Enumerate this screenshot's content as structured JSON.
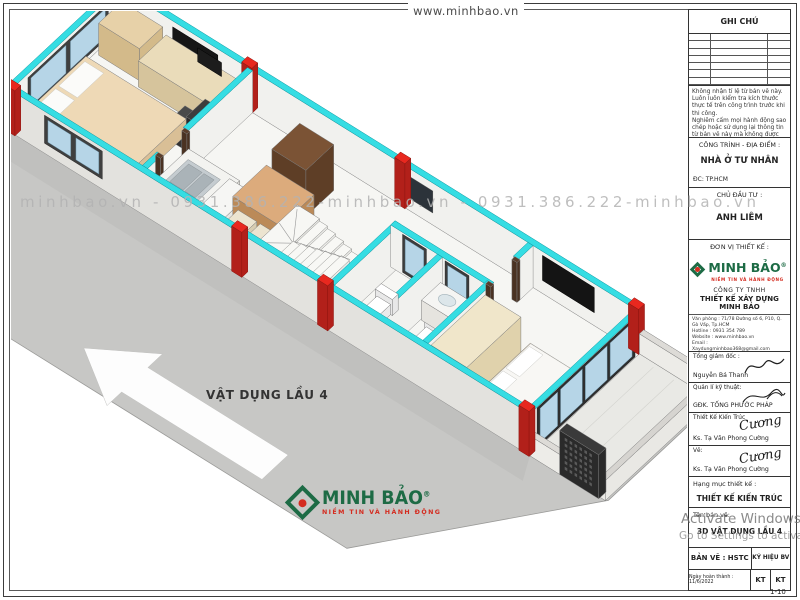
{
  "sheet": {
    "top_label": "www.minhbao.vn",
    "watermark": "minhbao.vn - 0931.386.222-minhbao.vn - 0931.386.222-minhbao.vn",
    "floor_label": "VẬT DỤNG LẦU 4",
    "footer_logo": {
      "brand": "MINH BẢO",
      "reg": "®",
      "tagline": "NIỀM TIN VÀ HÀNH ĐỘNG"
    },
    "activate": {
      "line1": "Activate Windows",
      "line2": "Go to Settings to activate Wi"
    }
  },
  "title_block": {
    "ghi_chu": "GHI CHÚ",
    "notes": [
      "Không nhận tỉ lệ từ bản vẽ này.",
      "Luôn luôn kiểm tra kích thước thực tế trên công trình trước khi thi công.",
      "Nghiêm cấm mọi hành động sao chép hoặc sử dụng lại thông tin từ bản vẽ này mà không được sự cho phép của Công ty TNHH THIẾT KẾ XÂY DỰNG MINH BẢO"
    ],
    "cong_trinh_label": "CÔNG TRÌNH - ĐỊA ĐIỂM :",
    "cong_trinh_value": "NHÀ Ở TƯ NHÂN",
    "dia_chi": "ĐC:   TP.HCM",
    "chu_dau_tu_label": "CHỦ ĐẦU TƯ :",
    "chu_dau_tu_value": "ANH LIÊM",
    "don_vi_label": "ĐƠN VỊ THIẾT KẾ :",
    "logo": {
      "brand": "MINH BẢO",
      "reg": "®",
      "tagline": "NIỀM TIN VÀ HÀNH ĐỘNG"
    },
    "company_type": "CÔNG TY TNHH",
    "company_name": "THIẾT KẾ XÂY DỰNG MINH BẢO",
    "contact": [
      "Văn phòng : 71/78 Đường số 6, P10, Q. Gò Vấp, Tp.HCM",
      "Hotline : 0931 354 789",
      "Website : www.minhbao.vn",
      "Email : Xaydungminhbao368@gmail.com",
      "MST : 0313863513"
    ],
    "rows": [
      {
        "label": "Tổng giám đốc :",
        "name": "Nguyễn Bá Thanh"
      },
      {
        "label": "Quản lí kỹ thuật:",
        "name": "GĐK. TỐNG PHƯỚC PHÁP"
      },
      {
        "label": "Thiết Kế Kiến Trúc",
        "name": "Ks. Tạ Văn Phong Cường",
        "sig": "Cương"
      },
      {
        "label": "Vẽ:",
        "name": "Ks. Tạ Văn Phong Cường",
        "sig": "Cương"
      }
    ],
    "hang_muc_label": "Hạng mục thiết kế :",
    "hang_muc_value": "THIẾT KẾ KIẾN TRÚC",
    "ten_ban_ve_label": "Tên bản vẽ:",
    "ten_ban_ve_value": "3D VẬT DỤNG LẦU 4",
    "ban_ve": "BẢN VẼ : HSTC",
    "ky_hieu": "KÝ HIỆU BV",
    "ngay": "Ngày hoàn thành : 11/6/2022",
    "kt_left": "KT",
    "kt_right": "KT",
    "scale": "1-10"
  },
  "colors": {
    "cyan": "#35dde3",
    "red": "#e8281f",
    "red_dark": "#b2201a",
    "brand_green": "#1d6b45",
    "brand_red": "#d42b1f",
    "slab": "#c7c7c5",
    "floor": "#f6f6f3",
    "wall_in": "#f1f1ee",
    "wall_out": "#e3e2de",
    "glass": "#b6d5e7"
  }
}
